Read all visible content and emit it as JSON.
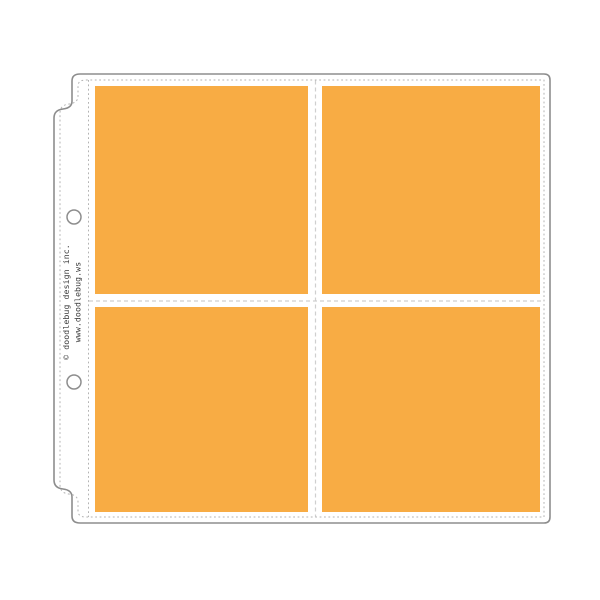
{
  "image": {
    "type": "product-photo",
    "subject": "Scrapbook page protector sleeve with four square pockets on white background"
  },
  "branding": {
    "line1": "© doodlebug design inc.",
    "line2": "www.doodlebug.ws"
  },
  "pockets": {
    "rows": 2,
    "cols": 2,
    "count": 4,
    "content": "blank orange inserts"
  },
  "holes": {
    "count": 2
  },
  "colors": {
    "pocket_orange": "#F8AC44",
    "outline_gray": "#8d8d8d",
    "stitch_gray": "#b3b3b3",
    "seam_gray": "#cfcfcf",
    "text_dark": "#3b3b3b",
    "background": "#ffffff"
  }
}
